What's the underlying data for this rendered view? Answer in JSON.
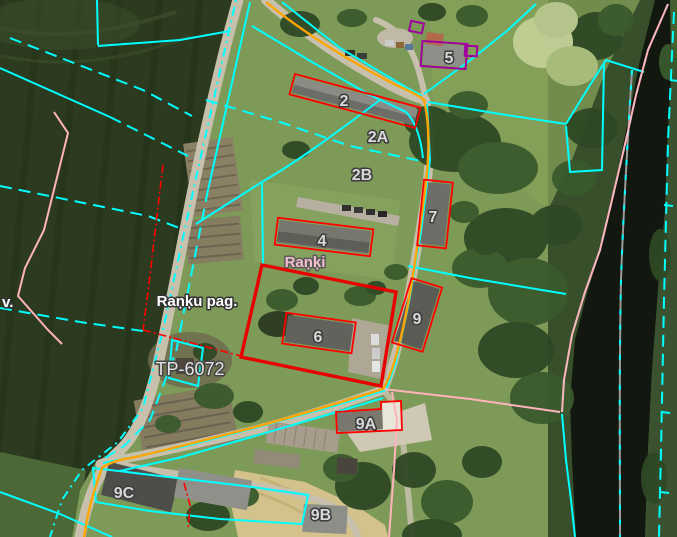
{
  "labels": {
    "settlement": "Raņķi",
    "parish": "Raņķu pag.",
    "left_edge_partial": "v.",
    "plan_code": "TP-6072",
    "addresses": [
      "2",
      "2A",
      "2B",
      "4",
      "5",
      "6",
      "7",
      "9",
      "9A",
      "9B",
      "9C"
    ]
  },
  "palette": {
    "parcel_line_cyan": "#00FFFF",
    "road_centerline_orange": "#FFA500",
    "building_outline_red": "#FF0000",
    "selected_parcel_red": "#E80000",
    "special_building_purple": "#A000A0",
    "boundary_pink": "#FFB3BB",
    "river_centerline_gray": "#9A9A9A",
    "address_label_gray": "#D8D8D8",
    "place_label_white": "#FFFFFF",
    "settlement_label_pink": "#F6BFCE"
  }
}
